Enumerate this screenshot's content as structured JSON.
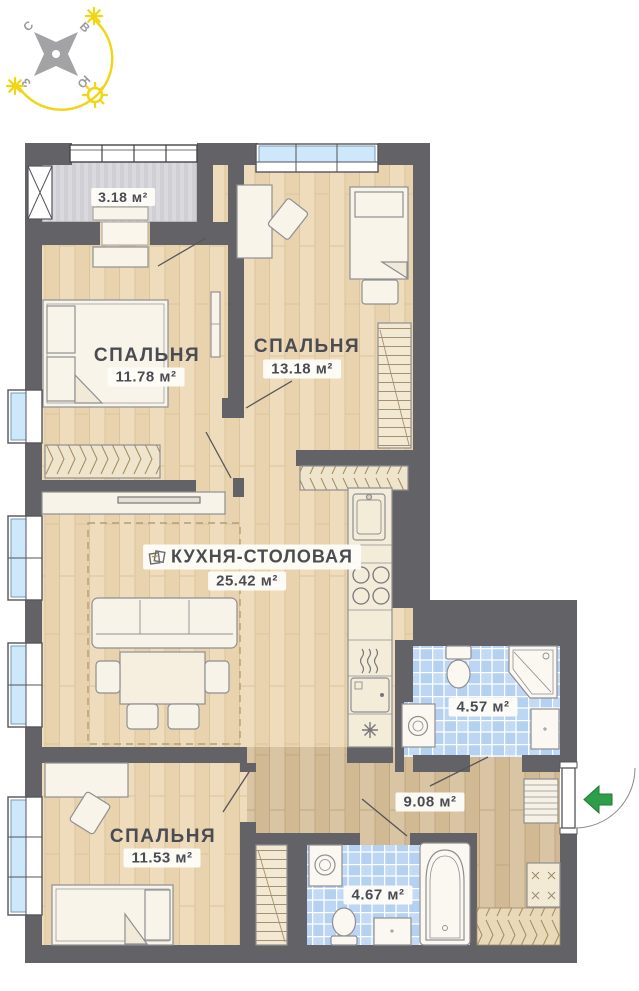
{
  "floorplan": {
    "title": "apartment-floor-plan",
    "compass": {
      "north": "С",
      "east": "В",
      "west": "З",
      "south": "Ю"
    },
    "rooms": {
      "balcony": {
        "area": "3.18 м²"
      },
      "bedroom1": {
        "name": "СПАЛЬНЯ",
        "area": "11.78 м²"
      },
      "bedroom2": {
        "name": "СПАЛЬНЯ",
        "area": "13.18 м²"
      },
      "kitchen": {
        "name": "КУХНЯ-СТОЛОВАЯ",
        "area": "25.42 м²"
      },
      "bathroom1": {
        "area": "4.57 м²"
      },
      "hallway": {
        "area": "9.08 м²"
      },
      "bedroom3": {
        "name": "СПАЛЬНЯ",
        "area": "11.53 м²"
      },
      "bathroom2": {
        "area": "4.67 м²"
      }
    },
    "colors": {
      "wall": "#636367",
      "floor_light": "#ecd9b8",
      "floor_dark": "#d5c09e",
      "tile": "#b6d3f2",
      "window_glass": "#cde8fa",
      "balcony_floor": "#d8d8dc",
      "entry_arrow": "#2f9e49",
      "sun_yellow": "#f2d512",
      "text": "#4b4b52"
    }
  }
}
